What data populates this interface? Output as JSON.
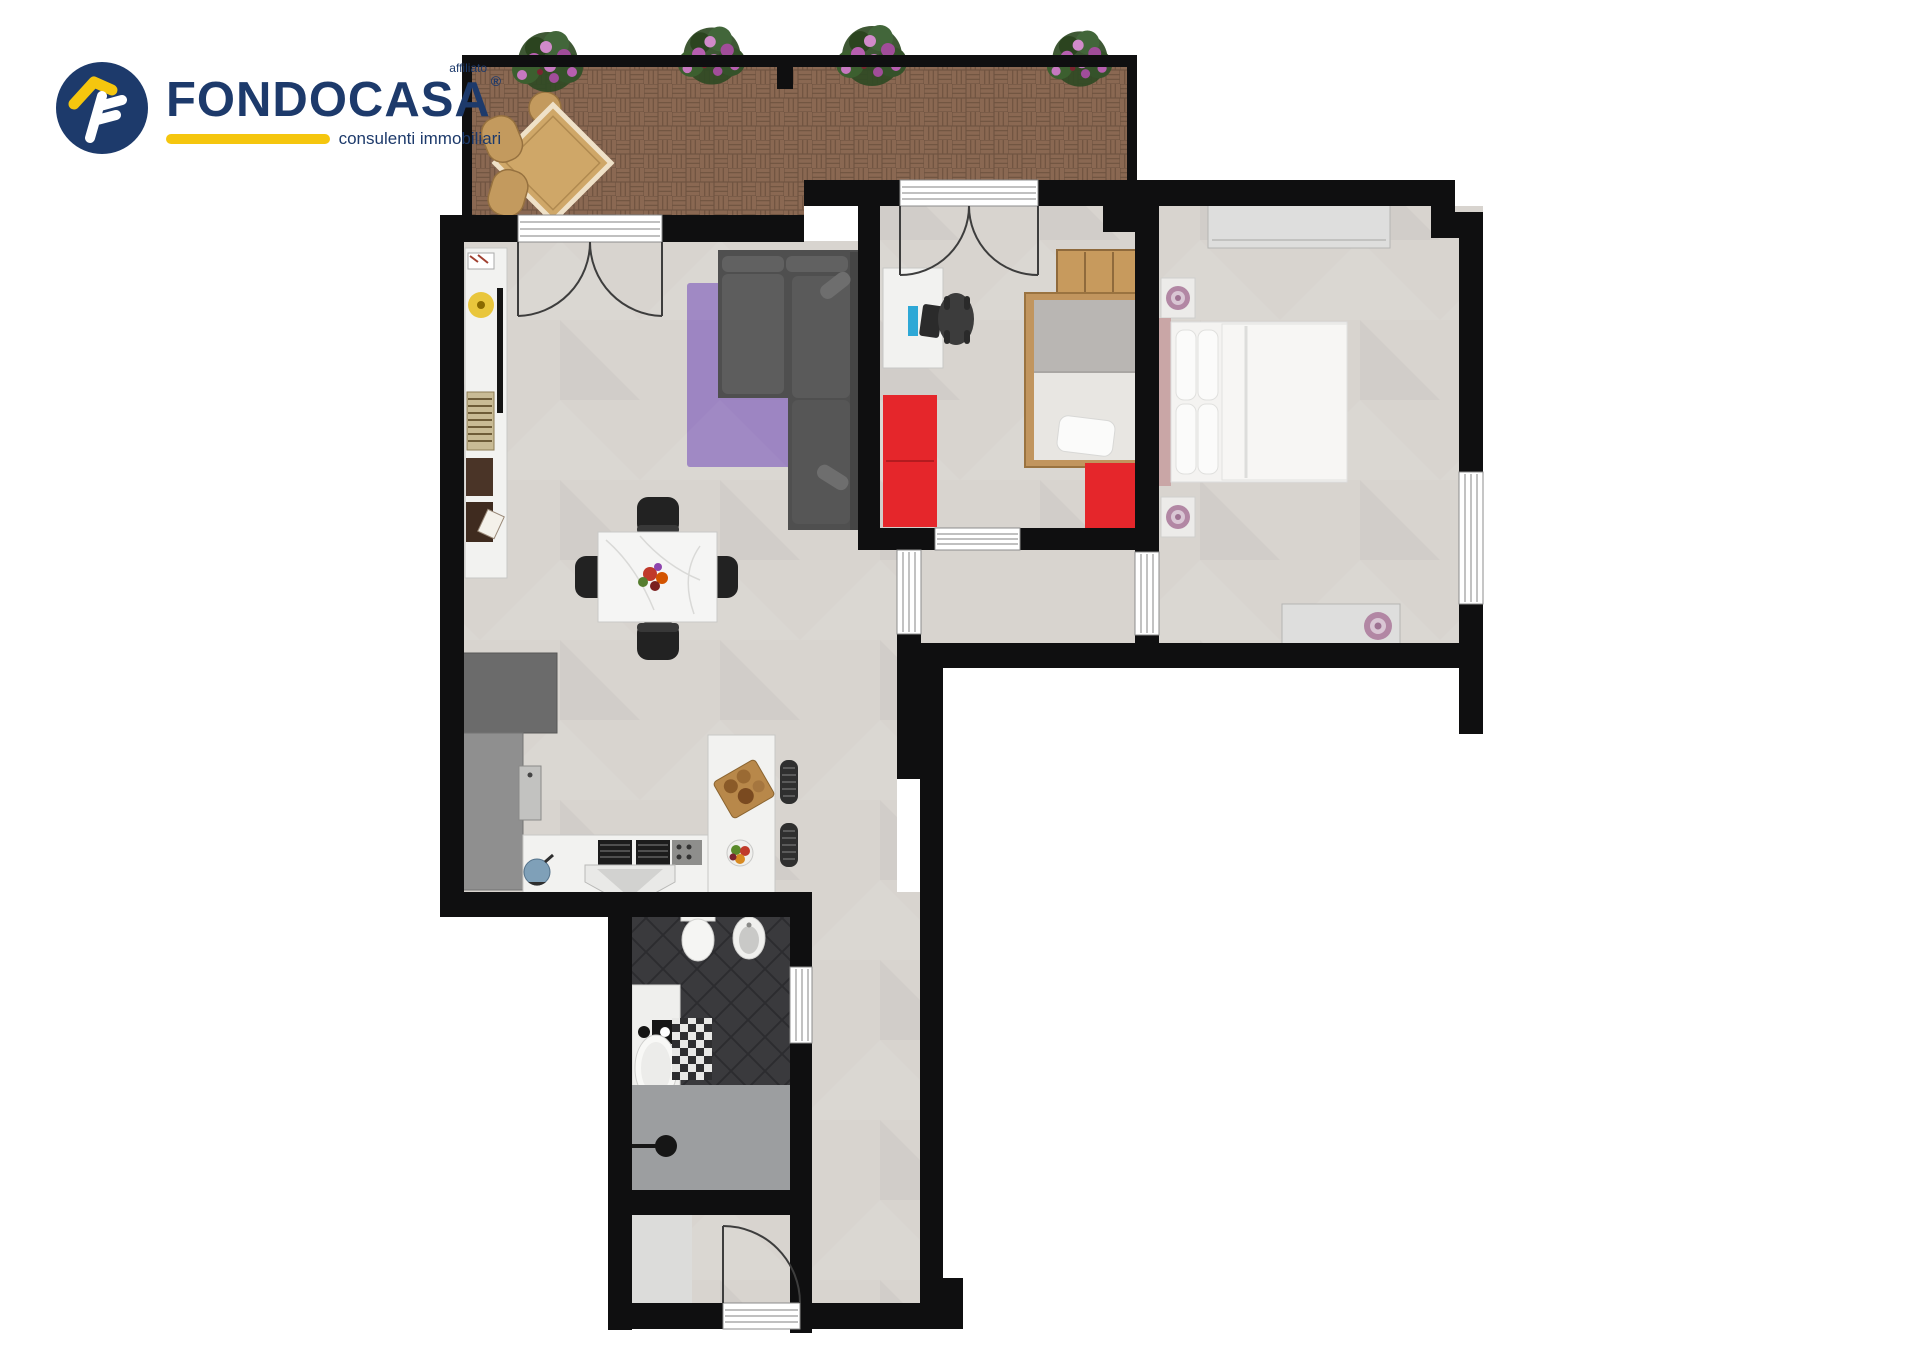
{
  "logo": {
    "brand": "FONDOCASA",
    "affiliate_label": "affiliato",
    "registered_mark": "®",
    "tagline": "consulenti immobiliari"
  },
  "palette": {
    "logo-navy": "#1d3a6b",
    "logo-yellow": "#f5c60e",
    "wall": "#0f0f10",
    "floor": "#d8d4cf",
    "terrace-brick": "#8a6852",
    "terrace-brick-dark": "#6f5340",
    "bath-floor": "#3a3a3d",
    "bath-tile-line": "#2c2c2f",
    "shower-gray": "#9c9ea0",
    "rug-purple": "#9d85c2",
    "sofa-gray": "#4f4f4f",
    "sofa-cushion": "#616161",
    "accent-red": "#e5262b",
    "wood": "#c39a5e",
    "wood-dark": "#96713f",
    "white-furniture": "#f2f2f0",
    "unit-gray": "#8f8f8f",
    "unit-dark": "#6b6b6b",
    "lamp-purple": "#b287a4",
    "plant-green": "#3c5f2f",
    "plant-flower": "#b75fb0",
    "door-line": "#3d3d3d",
    "window-line": "#9a9a9a",
    "computer-screen": "#2ea8d6"
  }
}
